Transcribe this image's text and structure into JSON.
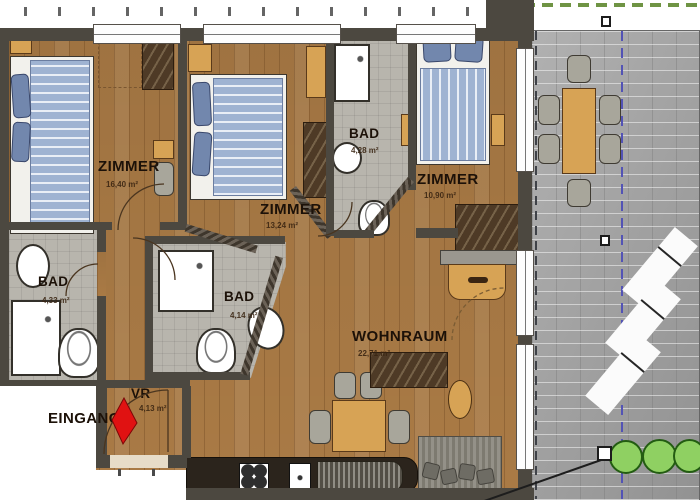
{
  "rooms": {
    "zimmer1": {
      "label": "ZIMMER",
      "area": "16,40 m²"
    },
    "zimmer2": {
      "label": "ZIMMER",
      "area": "13,24 m²"
    },
    "zimmer3": {
      "label": "ZIMMER",
      "area": "10,90 m²"
    },
    "bad_left": {
      "label": "BAD",
      "area": "4,33 m²"
    },
    "bad_mid": {
      "label": "BAD",
      "area": "4,14 m²"
    },
    "bad_top": {
      "label": "BAD",
      "area": "4,28 m²"
    },
    "wohnraum": {
      "label": "WOHNRAUM",
      "area": "22,71 m²"
    },
    "vr": {
      "label": "VR",
      "area": "4,13 m²"
    }
  },
  "entrance": {
    "label": "EINGANG"
  },
  "colors": {
    "wood": "#a97a45",
    "tile": "#b8b5ad",
    "wall": "#4c4840",
    "paver": "#a6a6a6",
    "accent-red": "#e01212",
    "bush-green": "#8fd062",
    "bush-border": "#235c12",
    "duvet-blue": "#9fb3d2",
    "pillow-blue": "#7287ad",
    "furniture-wood": "#d7a355",
    "dash-blue": "#5353b5",
    "dash-green": "#6f9444"
  }
}
